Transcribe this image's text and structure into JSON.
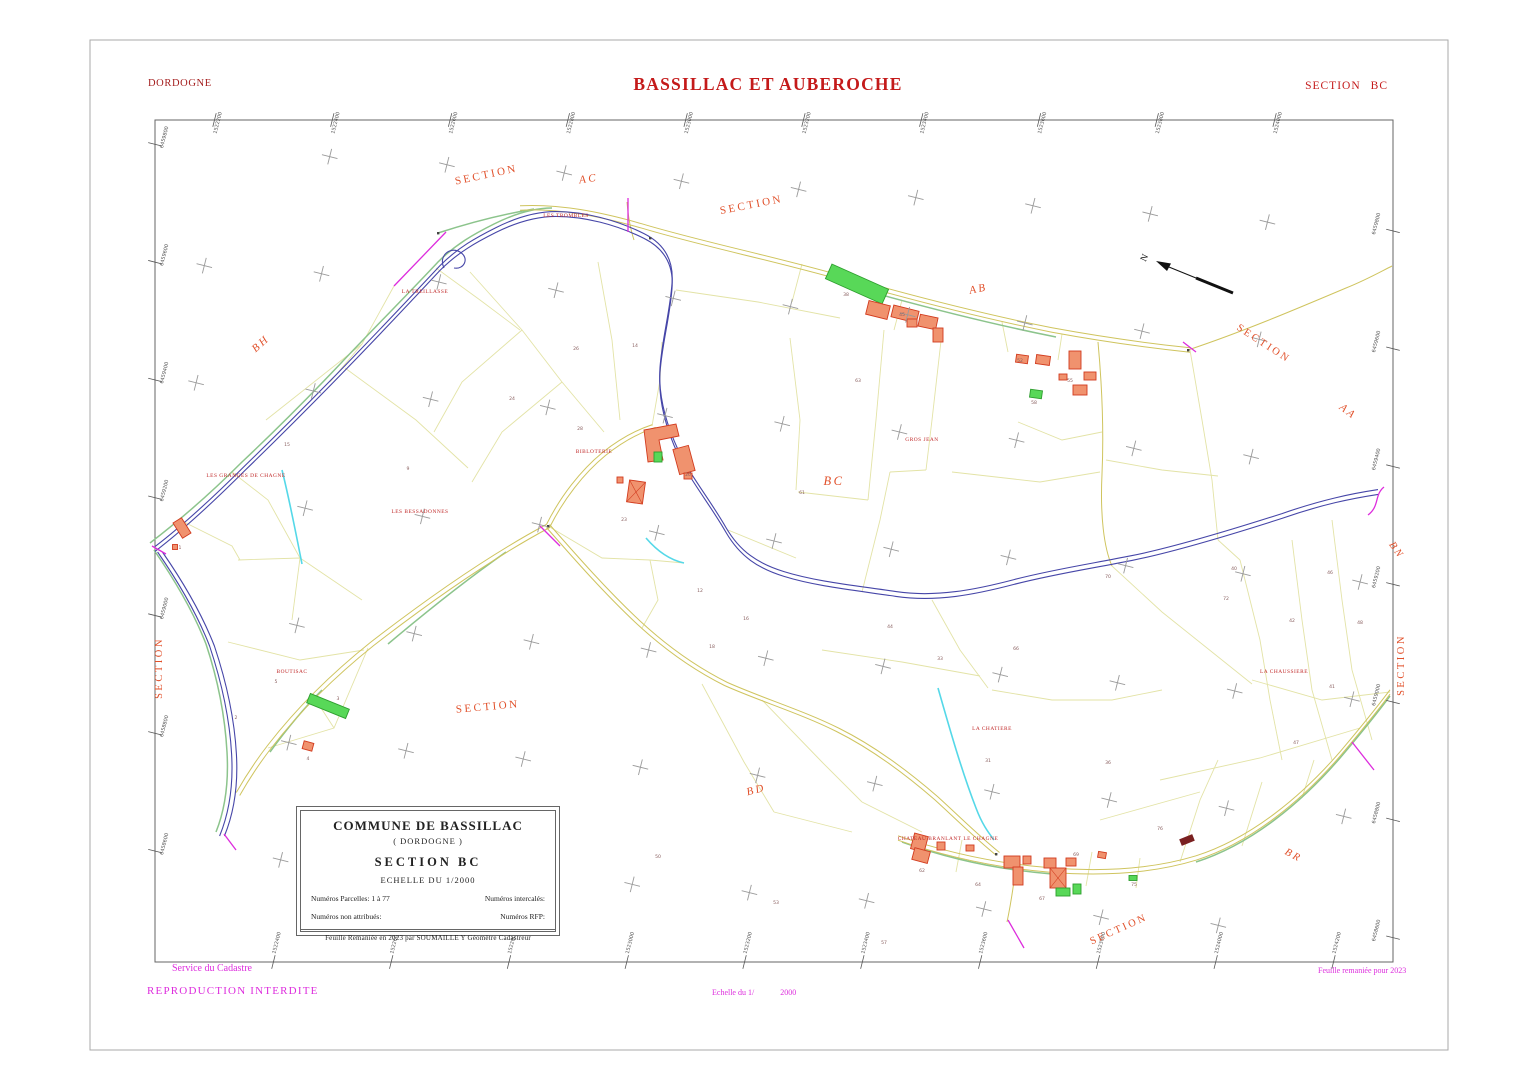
{
  "header": {
    "department": "DORDOGNE",
    "commune": "BASSILLAC ET AUBEROCHE",
    "section_word": "SECTION",
    "section_code": "BC"
  },
  "cartouche": {
    "title": "COMMUNE DE BASSILLAC",
    "subtitle": "( DORDOGNE )",
    "section": "SECTION  BC",
    "scale": "ECHELLE  DU  1/2000",
    "parcelles_label": "Numéros  Parcelles:  1 à 77",
    "intercales_label": "Numéros  intercalés:",
    "non_attribues_label": "Numéros  non  attribués:",
    "rfp_label": "Numéros  RFP:",
    "footnote": "Feuille Remaniée en 2023 par SOUMAILLE Y Géomètre Cadastreur"
  },
  "footer": {
    "service": "Service du Cadastre",
    "reproduction": "REPRODUCTION  INTERDITE",
    "scale_note_prefix": "Echelle du 1/",
    "scale_note_value": "2000",
    "revision_note": "Feuille remaniée pour 2023"
  },
  "colors": {
    "title_red": "#c41a1a",
    "section_orange": "#e1502a",
    "lieu_dit_red": "#c02828",
    "magenta": "#dd2cdd",
    "river_blue": "#4646a8",
    "road_yellow": "#cfc45e",
    "building_fill": "#f0926e",
    "building_stroke": "#d23b1e",
    "light_building_green": "#58d858"
  },
  "map": {
    "north_label": "N",
    "grid": {
      "spacing": 117.5,
      "rotation_deg": 4,
      "cross_tilt": 14,
      "cross_color": "#9a9a9a",
      "east_base": 1522000,
      "east_step": 200,
      "north_base": 6458400,
      "north_step": 200
    },
    "section_labels": [
      {
        "text": "SECTION",
        "x": 487,
        "y": 178,
        "rot": -12,
        "size": 11
      },
      {
        "text": "AC",
        "x": 589,
        "y": 182,
        "rot": -8,
        "size": 11,
        "italic": true
      },
      {
        "text": "SECTION",
        "x": 752,
        "y": 208,
        "rot": -11,
        "size": 11
      },
      {
        "text": "AB",
        "x": 979,
        "y": 292,
        "rot": -12,
        "size": 11,
        "italic": true
      },
      {
        "text": "BH",
        "x": 263,
        "y": 346,
        "rot": -42,
        "size": 11,
        "italic": true
      },
      {
        "text": "SECTION",
        "x": 1262,
        "y": 346,
        "rot": 33,
        "size": 10.5
      },
      {
        "text": "AA",
        "x": 1346,
        "y": 414,
        "rot": 38,
        "size": 11,
        "italic": true
      },
      {
        "text": "BC",
        "x": 834,
        "y": 485,
        "rot": 0,
        "size": 12.5,
        "italic": true
      },
      {
        "text": "BN",
        "x": 1394,
        "y": 552,
        "rot": 55,
        "size": 10.5,
        "italic": true
      },
      {
        "text": "SECTION",
        "x": 162,
        "y": 668,
        "rot": -90,
        "size": 10.5
      },
      {
        "text": "SECTION",
        "x": 1404,
        "y": 665,
        "rot": -90,
        "size": 10.5
      },
      {
        "text": "SECTION",
        "x": 488,
        "y": 710,
        "rot": -5,
        "size": 11
      },
      {
        "text": "BD",
        "x": 757,
        "y": 793,
        "rot": -15,
        "size": 11,
        "italic": true
      },
      {
        "text": "BR",
        "x": 1292,
        "y": 858,
        "rot": 28,
        "size": 10.5,
        "italic": true
      },
      {
        "text": "SECTION",
        "x": 1120,
        "y": 932,
        "rot": -24,
        "size": 10.5
      }
    ],
    "lieu_dits": [
      {
        "text": "LES TROMBLES",
        "x": 566,
        "y": 217
      },
      {
        "text": "LA TREILLASSE",
        "x": 425,
        "y": 293
      },
      {
        "text": "LES GRANGES DE CHAGNE",
        "x": 246,
        "y": 477
      },
      {
        "text": "LES BESSADONNES",
        "x": 420,
        "y": 513
      },
      {
        "text": "BIBLOTERIE",
        "x": 594,
        "y": 453
      },
      {
        "text": "BOUTISAC",
        "x": 292,
        "y": 673
      },
      {
        "text": "GROS JEAN",
        "x": 922,
        "y": 441
      },
      {
        "text": "LA CHATIERE",
        "x": 992,
        "y": 730
      },
      {
        "text": "LA CHAUSSIERE",
        "x": 1284,
        "y": 673
      },
      {
        "text": "CHATEAU BRANLANT LE CHAGNE",
        "x": 948,
        "y": 840
      }
    ],
    "parcel_numbers": [
      {
        "n": "1",
        "x": 180,
        "y": 549
      },
      {
        "n": "2",
        "x": 236,
        "y": 719
      },
      {
        "n": "5",
        "x": 276,
        "y": 683
      },
      {
        "n": "3",
        "x": 338,
        "y": 700
      },
      {
        "n": "4",
        "x": 308,
        "y": 760
      },
      {
        "n": "15",
        "x": 287,
        "y": 446
      },
      {
        "n": "9",
        "x": 408,
        "y": 470
      },
      {
        "n": "24",
        "x": 512,
        "y": 400
      },
      {
        "n": "26",
        "x": 576,
        "y": 350
      },
      {
        "n": "14",
        "x": 635,
        "y": 347
      },
      {
        "n": "28",
        "x": 580,
        "y": 430
      },
      {
        "n": "23",
        "x": 624,
        "y": 521
      },
      {
        "n": "20",
        "x": 688,
        "y": 476
      },
      {
        "n": "12",
        "x": 700,
        "y": 592
      },
      {
        "n": "18",
        "x": 712,
        "y": 648
      },
      {
        "n": "16",
        "x": 746,
        "y": 620
      },
      {
        "n": "61",
        "x": 802,
        "y": 494
      },
      {
        "n": "38",
        "x": 846,
        "y": 296
      },
      {
        "n": "45",
        "x": 902,
        "y": 316
      },
      {
        "n": "63",
        "x": 858,
        "y": 382
      },
      {
        "n": "52",
        "x": 1020,
        "y": 362
      },
      {
        "n": "55",
        "x": 1070,
        "y": 382
      },
      {
        "n": "58",
        "x": 1034,
        "y": 404
      },
      {
        "n": "44",
        "x": 890,
        "y": 628
      },
      {
        "n": "33",
        "x": 940,
        "y": 660
      },
      {
        "n": "66",
        "x": 1016,
        "y": 650
      },
      {
        "n": "70",
        "x": 1108,
        "y": 578
      },
      {
        "n": "72",
        "x": 1226,
        "y": 600
      },
      {
        "n": "40",
        "x": 1234,
        "y": 570
      },
      {
        "n": "42",
        "x": 1292,
        "y": 622
      },
      {
        "n": "46",
        "x": 1330,
        "y": 574
      },
      {
        "n": "48",
        "x": 1360,
        "y": 624
      },
      {
        "n": "31",
        "x": 988,
        "y": 762
      },
      {
        "n": "36",
        "x": 1108,
        "y": 764
      },
      {
        "n": "41",
        "x": 1332,
        "y": 688
      },
      {
        "n": "47",
        "x": 1296,
        "y": 744
      },
      {
        "n": "50",
        "x": 658,
        "y": 858
      },
      {
        "n": "53",
        "x": 776,
        "y": 904
      },
      {
        "n": "57",
        "x": 884,
        "y": 944
      },
      {
        "n": "62",
        "x": 922,
        "y": 872
      },
      {
        "n": "64",
        "x": 978,
        "y": 886
      },
      {
        "n": "67",
        "x": 1042,
        "y": 900
      },
      {
        "n": "69",
        "x": 1076,
        "y": 856
      },
      {
        "n": "75",
        "x": 1134,
        "y": 886
      },
      {
        "n": "76",
        "x": 1160,
        "y": 830
      }
    ]
  }
}
